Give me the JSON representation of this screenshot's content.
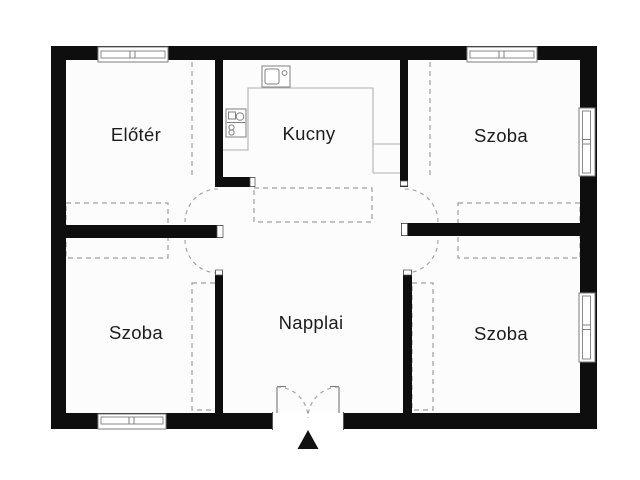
{
  "plan": {
    "type": "floor-plan",
    "rooms": [
      {
        "id": "eloter",
        "label": "Előtér"
      },
      {
        "id": "kucny",
        "label": "Kucny"
      },
      {
        "id": "szoba-top-right",
        "label": "Szoba"
      },
      {
        "id": "szoba-bottom-left",
        "label": "Szoba"
      },
      {
        "id": "napplai",
        "label": "Napplai"
      },
      {
        "id": "szoba-bottom-right",
        "label": "Szoba"
      }
    ],
    "icons": {
      "sink": "sink-icon",
      "stove": "stove-icon",
      "entrance_arrow": "entrance-arrow-icon",
      "window": "window-icon",
      "door_swing": "door-swing-icon"
    },
    "entrance": {
      "marker_glyph": "▲",
      "door_type": "double-swing"
    },
    "colors": {
      "wall": "#0e0e0e",
      "dashed_line": "#9e9e9e",
      "counter_line": "#b0b0b0",
      "text": "#1c1c1c",
      "background": "#ffffff",
      "floor": "#fcfcfc"
    }
  }
}
